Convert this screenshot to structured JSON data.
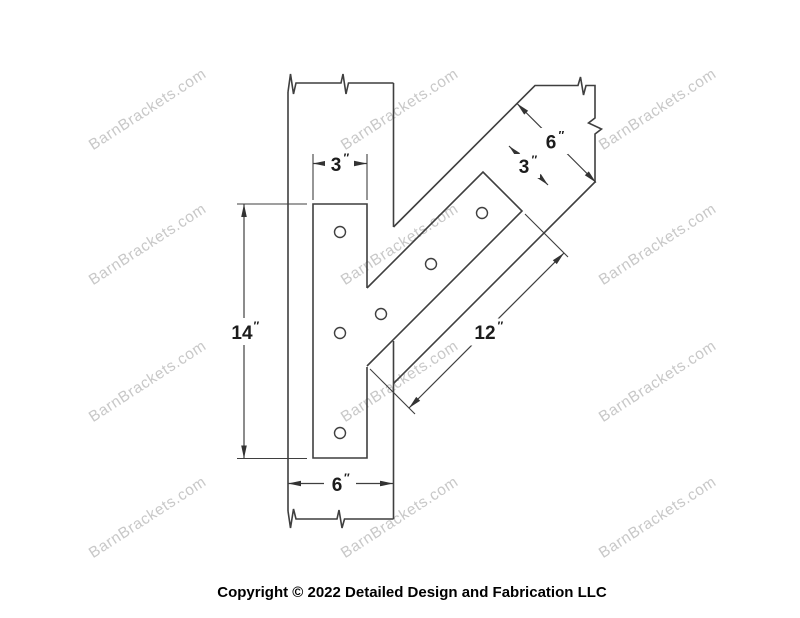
{
  "watermark": {
    "text": "BarnBrackets.com"
  },
  "footer": {
    "copyright": "Copyright © 2022 Detailed Design and Fabrication LLC"
  },
  "units": {
    "inch": "″"
  },
  "dims": {
    "plate_width": {
      "value": "3"
    },
    "plate_height": {
      "value": "14"
    },
    "post_width": {
      "value": "6"
    },
    "brace_width": {
      "value": "6"
    },
    "strap_width": {
      "value": "3"
    },
    "strap_length": {
      "value": "12"
    }
  }
}
